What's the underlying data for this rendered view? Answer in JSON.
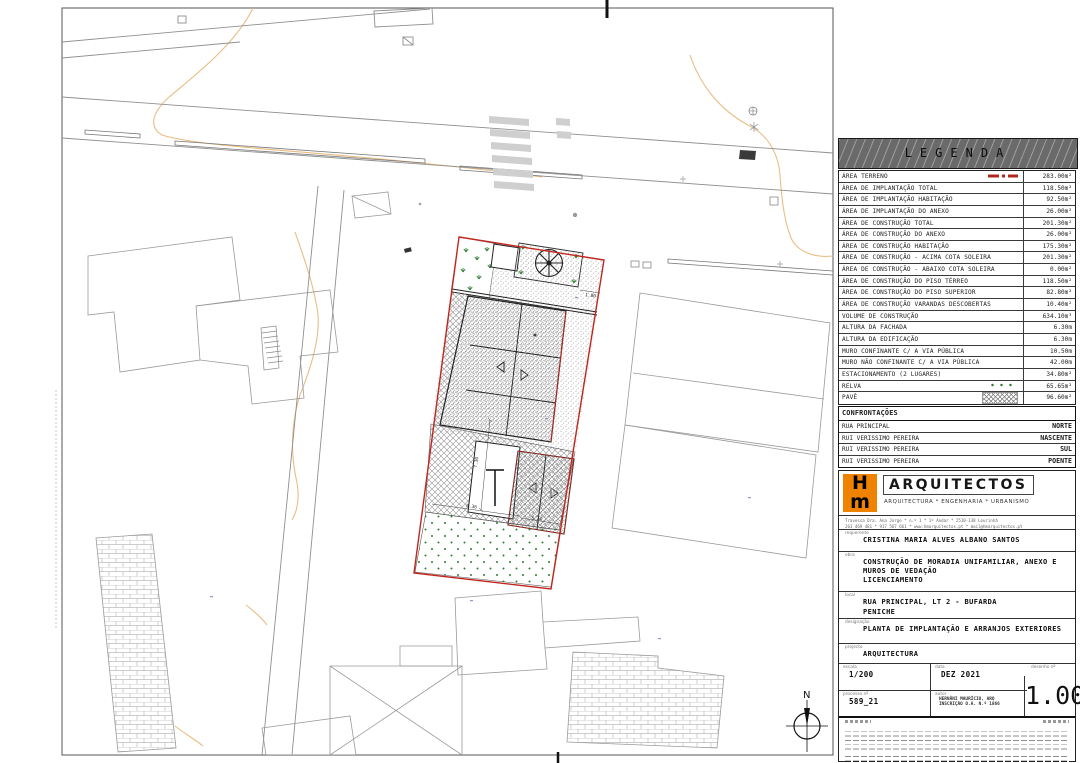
{
  "legend": {
    "title": "LEGENDA",
    "rows": [
      {
        "label": "ÁREA TERRENO",
        "value": "283.00m²",
        "chip": "terreno"
      },
      {
        "label": "ÁREA DE IMPLANTAÇÃO TOTAL",
        "value": "118.50m²"
      },
      {
        "label": "ÁREA DE IMPLANTAÇÃO HABITAÇÃO",
        "value": "92.50m²"
      },
      {
        "label": "ÁREA DE IMPLANTAÇÃO DO ANEXO",
        "value": "26.00m²"
      },
      {
        "label": "ÁREA DE CONSTRUÇÃO TOTAL",
        "value": "201.30m²"
      },
      {
        "label": "ÁREA DE CONSTRUÇÃO DO ANEXO",
        "value": "26.00m²"
      },
      {
        "label": "ÁREA DE CONSTRUÇÃO HABITAÇÃO",
        "value": "175.30m²"
      },
      {
        "label": "ÁREA DE CONSTRUÇÃO - ACIMA COTA SOLEIRA",
        "value": "201.30m²"
      },
      {
        "label": "ÁREA DE CONSTRUÇÃO - ABAIXO COTA SOLEIRA",
        "value": "0.00m²"
      },
      {
        "label": "ÁREA DE CONSTRUÇÃO DO PISO TÉRREO",
        "value": "118.50m²"
      },
      {
        "label": "ÁREA DE CONSTRUÇÃO DO PISO SUPERIOR",
        "value": "82.80m²"
      },
      {
        "label": "ÁREA DE CONSTRUÇÃO VARANDAS DESCOBERTAS",
        "value": "10.40m²"
      },
      {
        "label": "VOLUME DE CONSTRUÇÃO",
        "value": "634.10m³"
      },
      {
        "label": "ALTURA DA FACHADA",
        "value": "6.30m"
      },
      {
        "label": "ALTURA DA EDIFICAÇÃO",
        "value": "6.30m"
      },
      {
        "label": "MURO CONFINANTE C/ A VIA PÚBLICA",
        "value": "10.50m"
      },
      {
        "label": "MURO NÃO CONFINANTE C/ A VIA PÚBLICA",
        "value": "42.00m"
      },
      {
        "label": "ESTACIONAMENTO (2 LUGARES)",
        "value": "34.80m²"
      },
      {
        "label": "RELVA",
        "value": "65.65m²",
        "chip": "relva"
      },
      {
        "label": "PAVÊ",
        "value": "96.60m²",
        "chip": "pave"
      }
    ]
  },
  "confrontacoes": {
    "title": "CONFRONTAÇÕES",
    "rows": [
      {
        "label": "RUA PRINCIPAL",
        "value": "NORTE"
      },
      {
        "label": "RUI VERISSIMO PEREIRA",
        "value": "NASCENTE"
      },
      {
        "label": "RUI VERISSIMO PEREIRA",
        "value": "SUL"
      },
      {
        "label": "RUI VERISSIMO PEREIRA",
        "value": "POENTE"
      }
    ]
  },
  "firm": {
    "logo_top": "H",
    "logo_bottom": "m",
    "name": "ARQUITECTOS",
    "tagline": "ARQUITECTURA * ENGENHARIA * URBANISMO",
    "contact_line1": "Travessa Dra. Ana Jorge * n.º 1 * 1º Andar * 2510-138 Lourinhã",
    "contact_line2": "261 469 481 * 917 567 661 * www.hmarquitectos.pt * mail@hmarquitectos.pt"
  },
  "titleblock": {
    "requerente_label": "requerente",
    "requerente": "CRISTINA MARIA ALVES ALBANO SANTOS",
    "obra_label": "obra",
    "obra_line1": "CONSTRUÇÃO DE MORADIA UNIFAMILIAR, ANEXO E",
    "obra_line2": "MUROS DE VEDAÇÃO",
    "obra_line3": "LICENCIAMENTO",
    "local_label": "local",
    "local_line1": "RUA PRINCIPAL, LT 2 - BUFARDA",
    "local_line2": "PENICHE",
    "designacao_label": "designação",
    "designacao": "PLANTA DE IMPLANTAÇÃO E ARRANJOS EXTERIORES",
    "projecto_label": "projecto",
    "projecto": "ARQUITECTURA",
    "escala_label": "escala",
    "escala": "1/200",
    "data_label": "data",
    "data": "DEZ 2021",
    "desenho_label": "desenho nº",
    "desenho_numero": "1.00",
    "processo_label": "processo nº",
    "processo": "589_21",
    "autor_label": "autor",
    "autor_line1": "HERNÂNI MAURÍCIO, ARQ",
    "autor_line2": "INSCRIÇÃO O.A. N.º 1866"
  },
  "plan": {
    "north_label": "N",
    "dim_vertical": "7.30",
    "dim_horizontal1": "8.36",
    "dim_horizontal2": "3.34",
    "dim_top": "1.80",
    "colors": {
      "boundary_red": "#c0261e",
      "contour_orange": "#e8b97c",
      "grass_green": "#2e7d32",
      "road_gray": "#8f8f8f",
      "logo_orange": "#ef8200"
    }
  }
}
